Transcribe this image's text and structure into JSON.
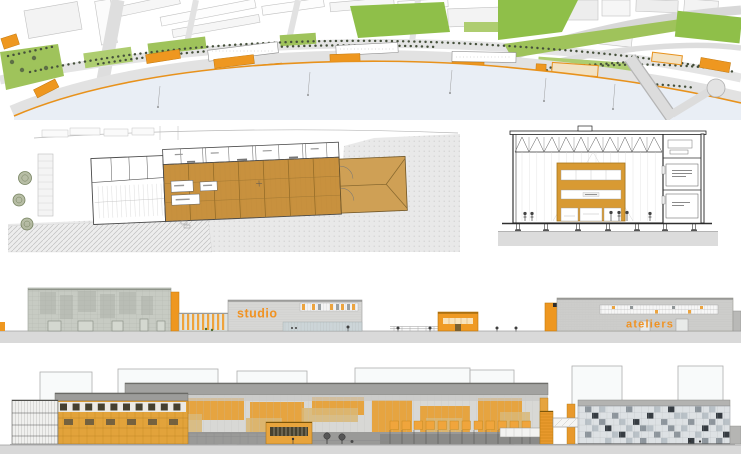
{
  "labels": {
    "studio": "studio",
    "ateliers": "ateliers"
  },
  "colors": {
    "accent_orange": "#ee9720",
    "wood_tan": "#c8913e",
    "water_blue": "#e9eef5",
    "lawn_green": "#8fbf49",
    "ground_gray": "#d8d8d8",
    "facade_gray": "#c7cbc3",
    "mosaic_dark": "#363c42"
  }
}
